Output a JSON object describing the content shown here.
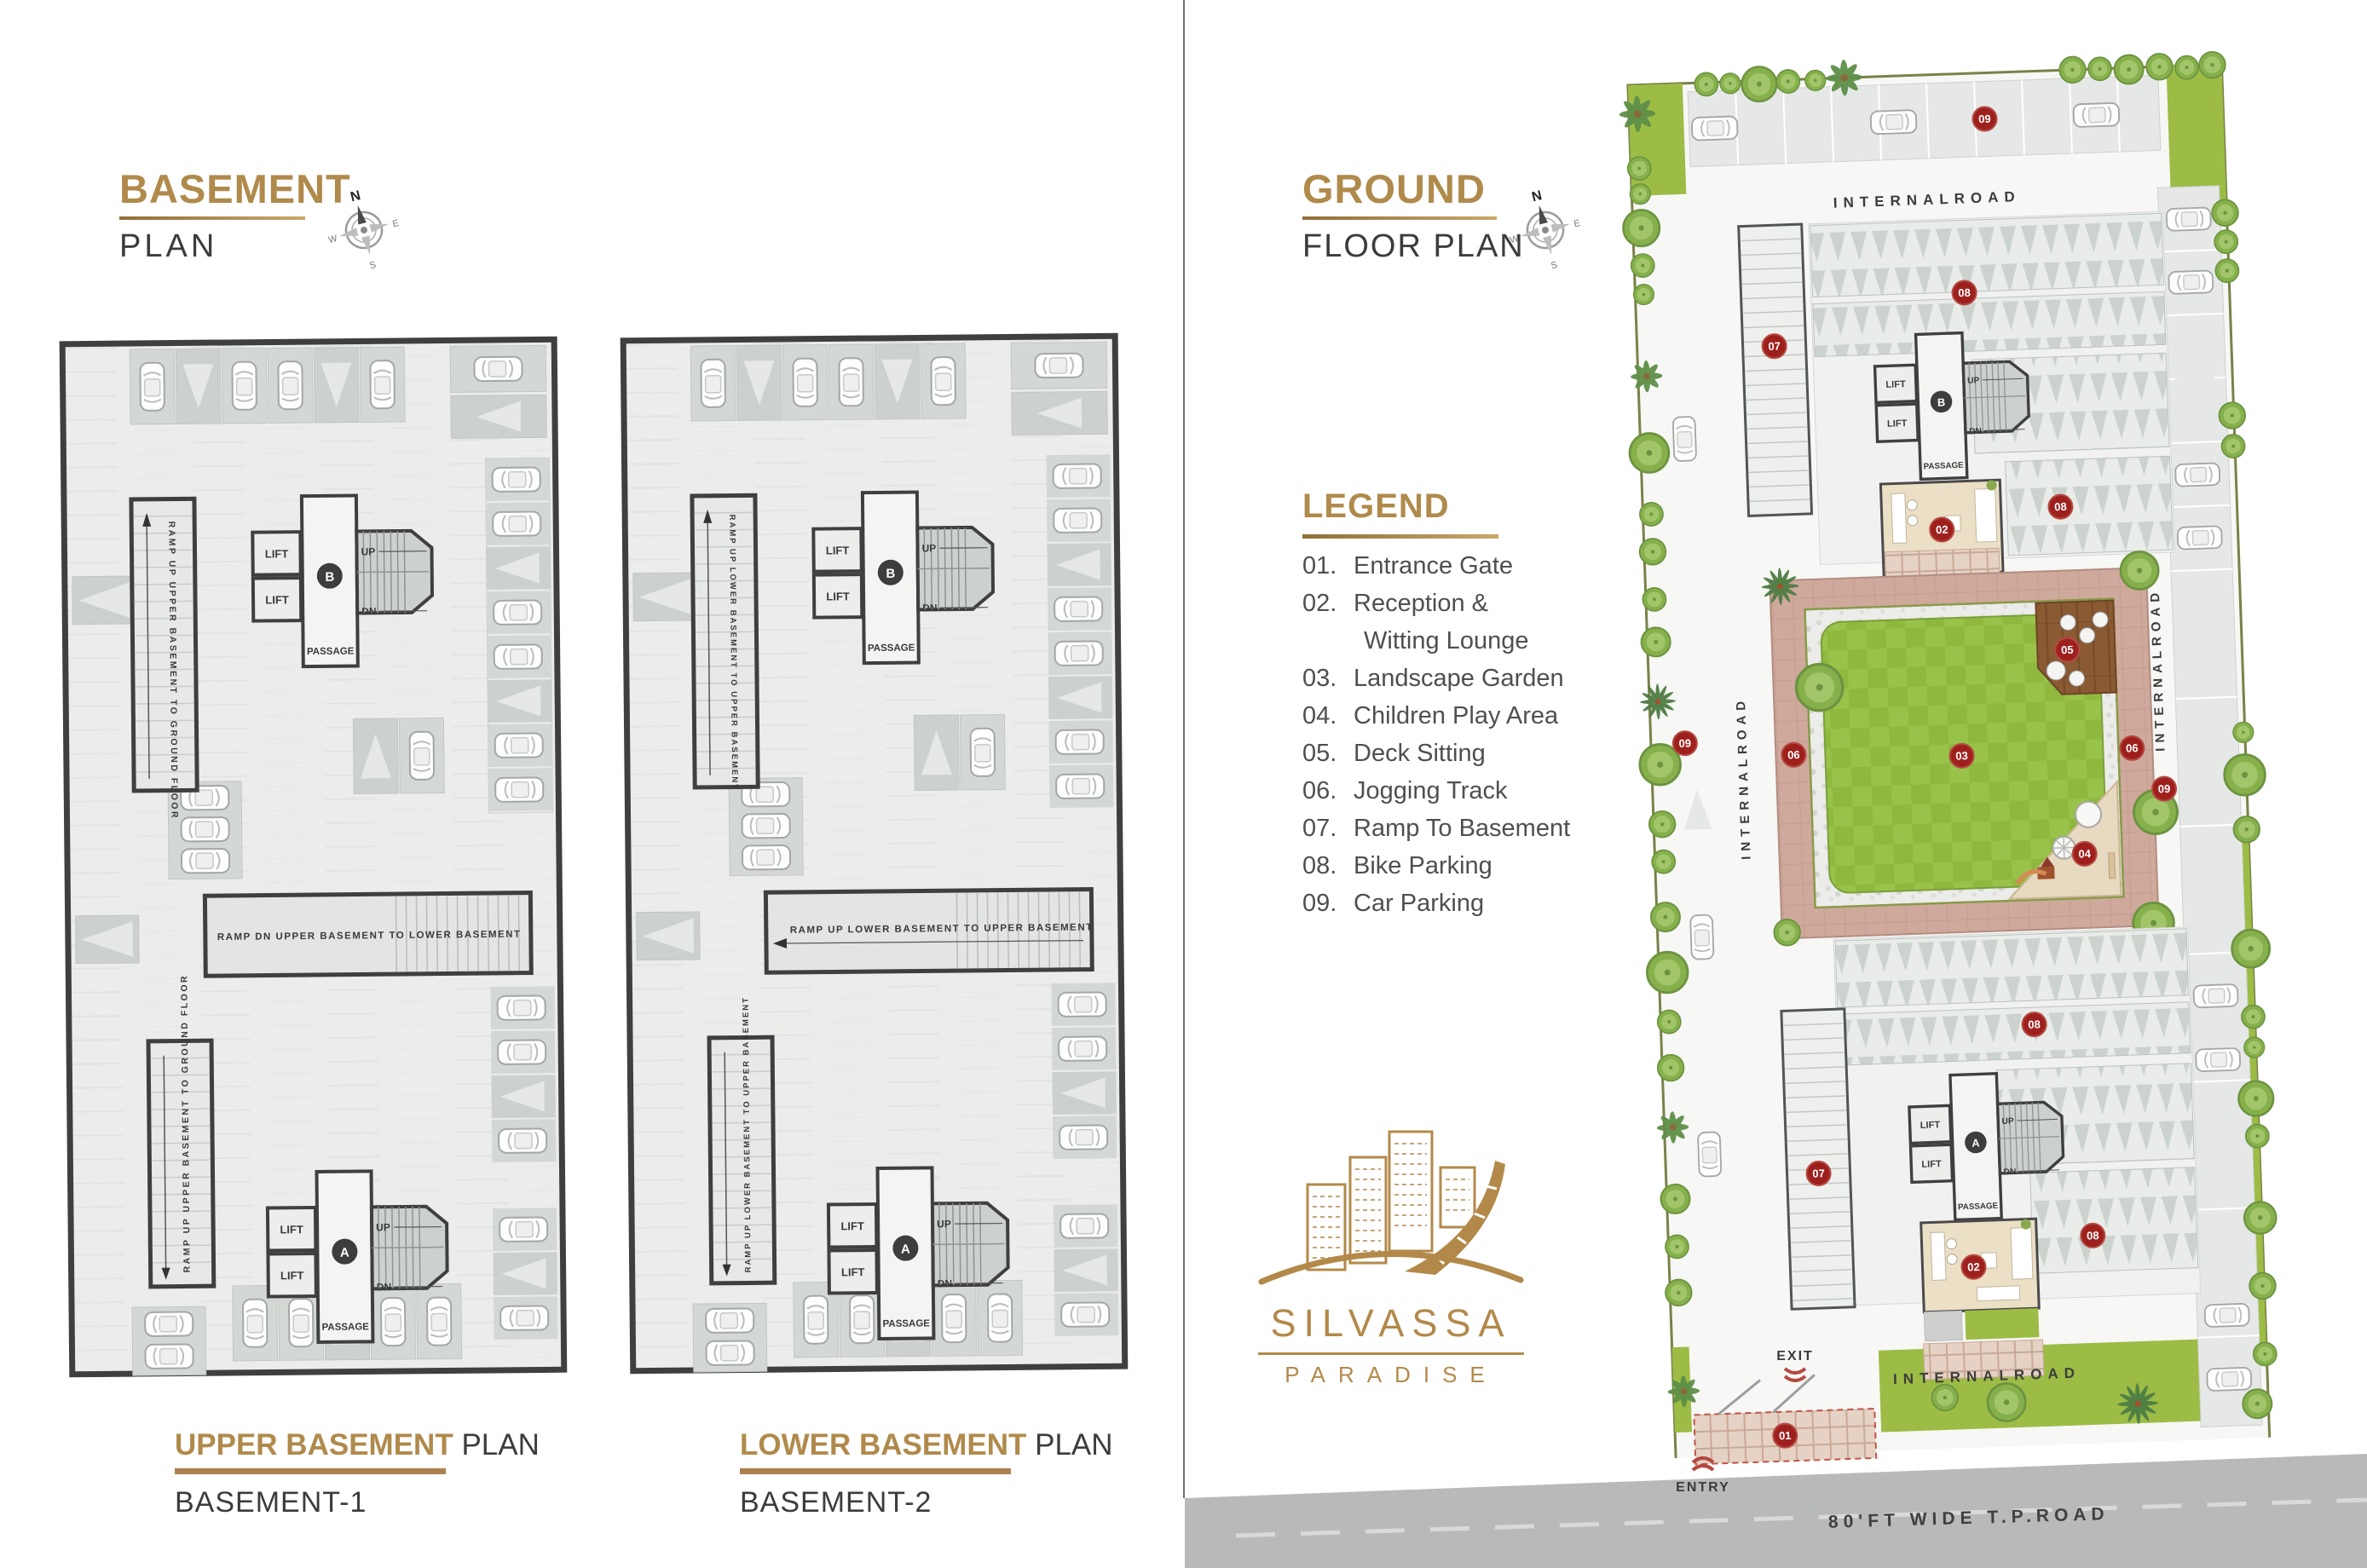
{
  "left_page": {
    "title": "BASEMENT",
    "subtitle": "PLAN",
    "captions": {
      "upper": {
        "highlight": "UPPER BASEMENT",
        "rest": " PLAN",
        "sub": "BASEMENT-1"
      },
      "lower": {
        "highlight": "LOWER BASEMENT",
        "rest": " PLAN",
        "sub": "BASEMENT-2"
      }
    }
  },
  "right_page": {
    "title": "GROUND",
    "subtitle": "FLOOR PLAN",
    "legend": {
      "title": "LEGEND",
      "items": [
        {
          "num": "01.",
          "label": "Entrance Gate"
        },
        {
          "num": "02.",
          "label": "Reception &",
          "label2": "Witting Lounge"
        },
        {
          "num": "03.",
          "label": "Landscape Garden"
        },
        {
          "num": "04.",
          "label": "Children Play Area"
        },
        {
          "num": "05.",
          "label": "Deck Sitting"
        },
        {
          "num": "06.",
          "label": "Jogging Track"
        },
        {
          "num": "07.",
          "label": "Ramp To Basement"
        },
        {
          "num": "08.",
          "label": "Bike Parking"
        },
        {
          "num": "09.",
          "label": "Car Parking"
        }
      ]
    },
    "logo": {
      "name": "SILVASSA",
      "tagline": "PARADISE"
    }
  },
  "compass": {
    "n": "N",
    "e": "E",
    "w": "W",
    "s": "S"
  },
  "plan_labels": {
    "lift": "LIFT",
    "up": "UP",
    "dn": "DN",
    "passage": "PASSAGE",
    "tower_a": "A",
    "tower_b": "B",
    "ramp_central_b1": "RAMP DN UPPER BASEMENT TO LOWER BASEMENT",
    "ramp_central_b2": "RAMP UP LOWER BASEMENT TO UPPER BASEMENT",
    "ramp_vertical_b1": "RAMP UP UPPER BASEMENT TO GROUND FLOOR",
    "ramp_vertical_b2": "RAMP UP LOWER BASEMENT TO UPPER BASEMENT"
  },
  "site": {
    "internal_road": "INTERNALROAD",
    "entry": "ENTRY",
    "exit": "EXIT",
    "tp_road": "80'FT WIDE T.P.ROAD",
    "markers": {
      "m01": "01",
      "m02": "02",
      "m03": "03",
      "m04": "04",
      "m05": "05",
      "m06": "06",
      "m07": "07",
      "m08": "08",
      "m09": "09"
    }
  },
  "colors": {
    "gold": "#b08a4b",
    "dark_text": "#3c3c3c",
    "legend_text": "#4f4f4f",
    "marker_red": "#9e201d",
    "lawn_green": "#8fb83e",
    "track_pink": "#cfa99c",
    "deck_brown": "#8a5a33",
    "play_beige": "#e8d9c1",
    "road_gray": "#b7bab8",
    "plan_fill": "#ecedeb",
    "border_dark": "#3f3f3f"
  }
}
